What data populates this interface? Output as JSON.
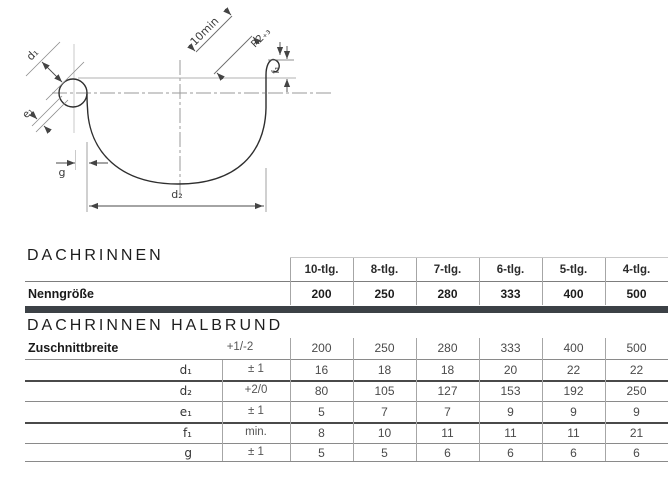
{
  "diagram": {
    "labels": {
      "d1": "d₁",
      "d2": "d₂",
      "e1": "e₁",
      "f1": "f₁",
      "g": "g",
      "min10": "10min",
      "r2": "R2₊₃"
    }
  },
  "table1": {
    "title": "DACHRINNEN",
    "col_headers": [
      "10-tlg.",
      "8-tlg.",
      "7-tlg.",
      "6-tlg.",
      "5-tlg.",
      "4-tlg."
    ],
    "nenngroesse_label": "Nenngröße",
    "nenngroesse": [
      "200",
      "250",
      "280",
      "333",
      "400",
      "500"
    ]
  },
  "table2": {
    "title": "DACHRINNEN HALBRUND",
    "zuschnitt_label": "Zuschnittbreite",
    "zuschnitt_tol": "+1/-2",
    "zuschnitt": [
      "200",
      "250",
      "280",
      "333",
      "400",
      "500"
    ],
    "rows": [
      {
        "sub": "d₁",
        "tol": "± 1",
        "values": [
          "16",
          "18",
          "18",
          "20",
          "22",
          "22"
        ]
      },
      {
        "sub": "d₂",
        "tol": "+2/0",
        "values": [
          "80",
          "105",
          "127",
          "153",
          "192",
          "250"
        ]
      },
      {
        "sub": "e₁",
        "tol": "± 1",
        "values": [
          "5",
          "7",
          "7",
          "9",
          "9",
          "9"
        ]
      },
      {
        "sub": "f₁",
        "tol": "min.",
        "values": [
          "8",
          "10",
          "11",
          "11",
          "11",
          "21"
        ]
      },
      {
        "sub": "g",
        "tol": "± 1",
        "values": [
          "5",
          "5",
          "6",
          "6",
          "6",
          "6"
        ]
      }
    ]
  },
  "colors": {
    "dark_bar": "#3c4146",
    "line": "#8a8a8a",
    "text": "#222222"
  }
}
